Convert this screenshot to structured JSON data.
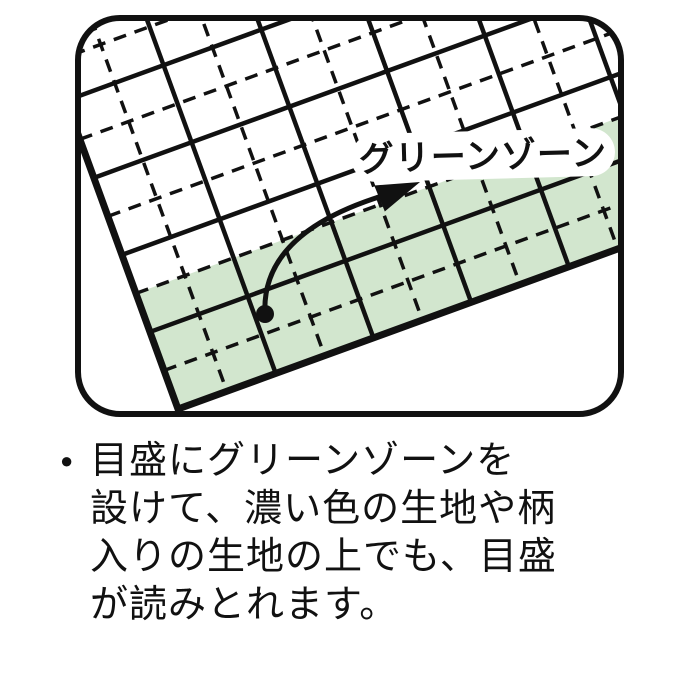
{
  "illustration": {
    "label": "グリーンゾーン",
    "colors": {
      "green_zone": "#d2e6ce",
      "line": "#111111",
      "background": "#ffffff"
    }
  },
  "note": {
    "bullet": "●",
    "lines": [
      "目盛にグリーンゾーンを",
      "設けて、濃い色の生地や柄",
      "入りの生地の上でも、目盛",
      "が読みとれます。"
    ]
  }
}
